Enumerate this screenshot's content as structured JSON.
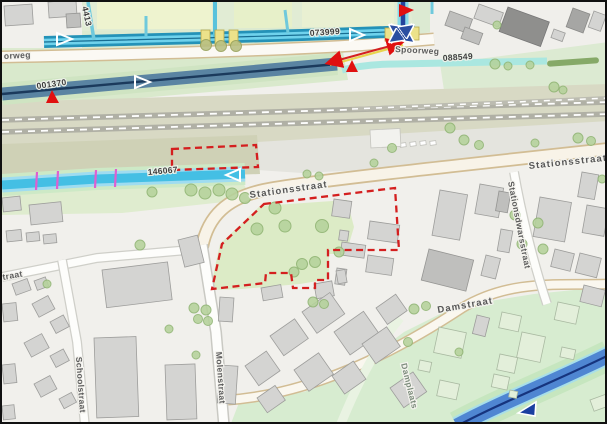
{
  "map": {
    "street_labels": {
      "spoorweg_partial": "orweg",
      "spoorweg": "Spoorweg",
      "stationsstraat_west": "Stationsstraat",
      "stationsstraat_east": "Stationsstraat",
      "stationsdwarsstraat": "Stationsdwarsstraat",
      "molenstraat": "Molenstraat",
      "schoolstraat": "Schoolstraat",
      "damstraat": "Damstraat",
      "damplaats": "Damplaats",
      "street_partial_sw": "traat"
    },
    "waterway_ids": {
      "id_001370": "001370",
      "id_073999": "073999",
      "id_088549": "088549",
      "id_146067": "146067",
      "id_4413": "4413"
    },
    "colors": {
      "selection_outline_red": "#d41f1f",
      "marker_red": "#e01010",
      "canal_blue": "#4f86d2",
      "channel_cyan": "#44bfe4",
      "channel_dark_blue": "#5a84a2",
      "channel_teal": "#2492b8",
      "channel_pale": "#aae7e0",
      "flow_arrow_blue": "#2b4fa0",
      "culvert_yellow": "#ece28a",
      "tick_magenta": "#df5fd0",
      "road_casing_tan": "#d2bd94",
      "green_area": "#dcead0",
      "building_gray": "#d4d4d2",
      "railway_gray": "#b0b0a5"
    }
  }
}
